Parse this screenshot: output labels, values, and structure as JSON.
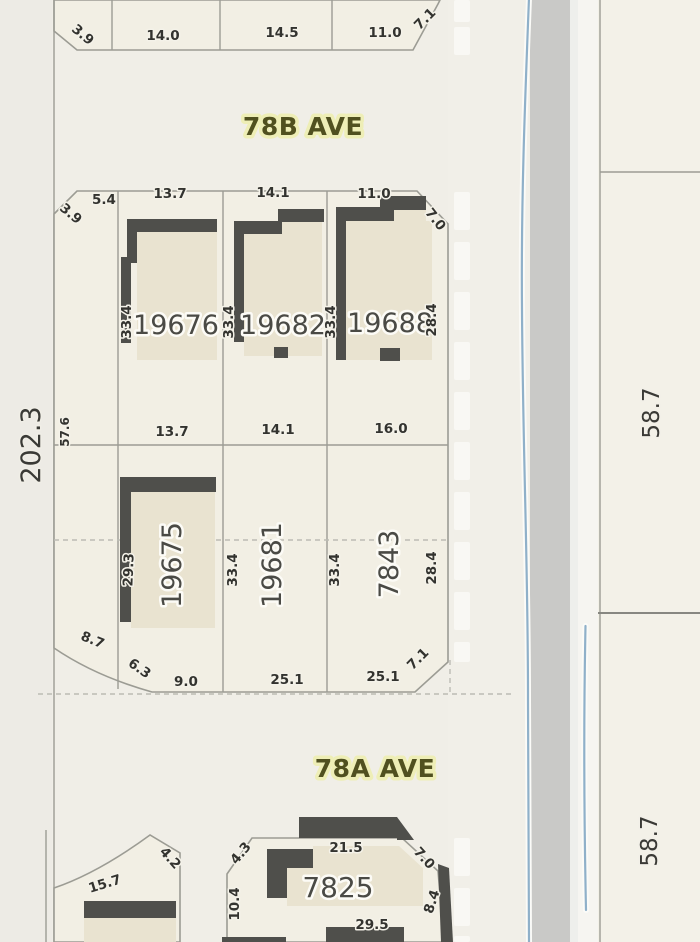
{
  "colors": {
    "background": "#f0eee7",
    "parcel_fill": "#f2efe4",
    "parcel_line": "#9c9c94",
    "building_wall": "#4f4f4b",
    "building_fill": "#e9e3d0",
    "road_fill": "#c9c9c7",
    "water_line": "#8fb0c9",
    "street_label_text": "#50501f",
    "street_label_halo": "#eeeeb6",
    "dimension_text": "#33332f"
  },
  "streets": {
    "ave_78b": "78B AVE",
    "ave_78a": "78A AVE"
  },
  "west_dims": {
    "block_length": "202.3",
    "strip_depth": "57.6"
  },
  "east_dims": {
    "north_parcel": "58.7",
    "south_parcel": "58.7"
  },
  "north_block": {
    "corner_w": "3.9",
    "frontages": [
      "14.0",
      "14.5",
      "11.0"
    ],
    "corner_e": "7.1"
  },
  "upper_row": {
    "corner_w": "3.9",
    "strip_frontage": "5.4",
    "corner_e": "7.0",
    "right_depth": "28.4",
    "lots": [
      {
        "id": "19676",
        "frontage": "13.7",
        "depth": "33.4",
        "rear": "13.7"
      },
      {
        "id": "19682",
        "frontage": "14.1",
        "depth": "33.4",
        "rear": "14.1"
      },
      {
        "id": "19688",
        "frontage": "11.0",
        "depth": "33.4",
        "rear": "16.0"
      }
    ]
  },
  "lower_row": {
    "corner_sw": [
      "8.7",
      "6.3"
    ],
    "corner_se": "7.1",
    "right_depth": "28.4",
    "lots": [
      {
        "id": "19675",
        "depth": "29.3",
        "frontage": "9.0"
      },
      {
        "id": "19681",
        "depth": "33.4",
        "frontage": "25.1"
      },
      {
        "id": "7843",
        "depth": "33.4",
        "frontage": "25.1"
      }
    ]
  },
  "south_block": {
    "curved_lot": {
      "arc": "15.7",
      "corner": "4.2"
    },
    "lot_7825": {
      "id": "7825",
      "corner_w": "4.3",
      "front": "21.5",
      "corner_e": "7.0",
      "side_w": "10.4",
      "side_e": "8.4",
      "rear": "29.5"
    }
  }
}
